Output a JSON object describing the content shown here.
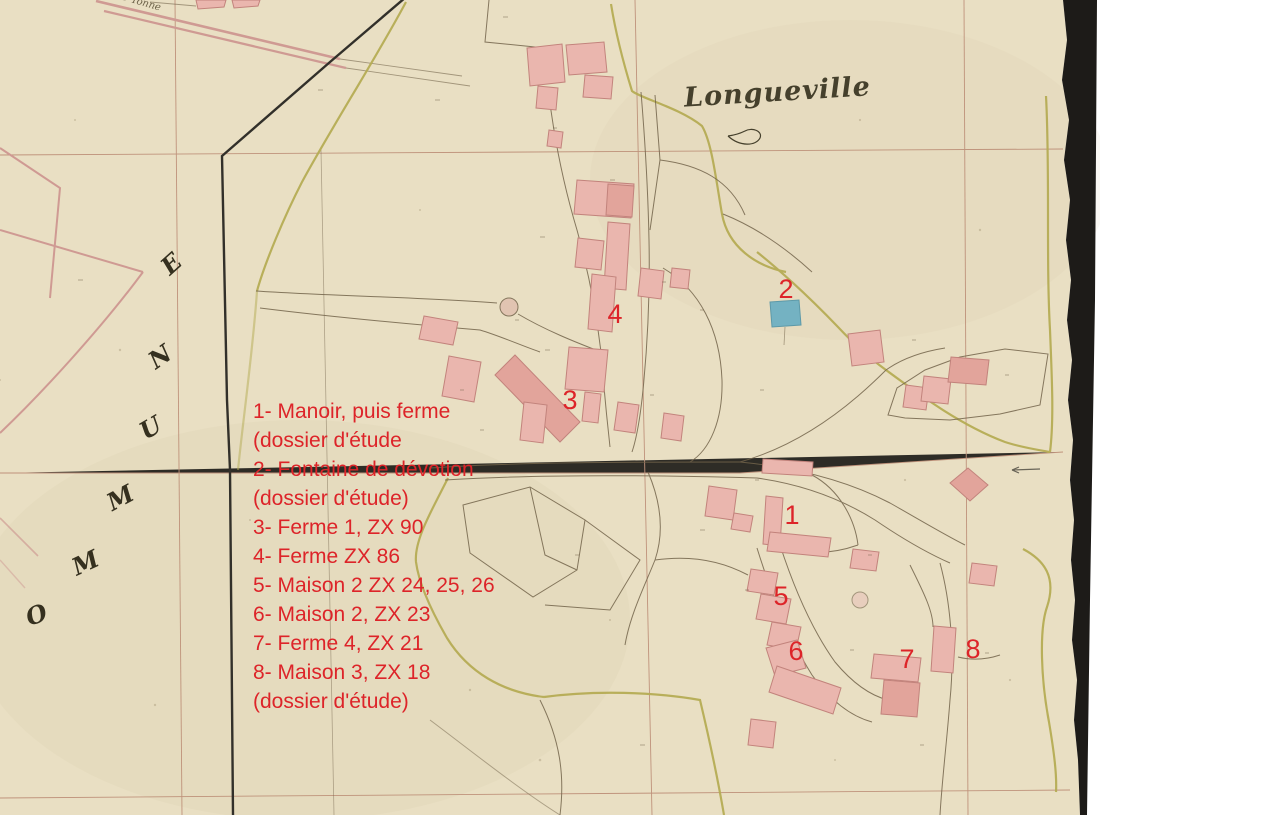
{
  "map": {
    "title": "Longueville",
    "road_label": "D'Yonne",
    "commune_letters": [
      {
        "ch": "O",
        "x": 26,
        "y": 600,
        "rot": -20
      },
      {
        "ch": "M",
        "x": 72,
        "y": 548,
        "rot": -25
      },
      {
        "ch": "M",
        "x": 107,
        "y": 483,
        "rot": -28
      },
      {
        "ch": "U",
        "x": 140,
        "y": 413,
        "rot": -30
      },
      {
        "ch": "N",
        "x": 149,
        "y": 342,
        "rot": -35
      },
      {
        "ch": "E",
        "x": 162,
        "y": 249,
        "rot": -42
      }
    ],
    "markers": [
      {
        "n": "1",
        "x": 792,
        "y": 517
      },
      {
        "n": "2",
        "x": 786,
        "y": 291
      },
      {
        "n": "3",
        "x": 570,
        "y": 402
      },
      {
        "n": "4",
        "x": 615,
        "y": 316
      },
      {
        "n": "5",
        "x": 781,
        "y": 598
      },
      {
        "n": "6",
        "x": 796,
        "y": 653
      },
      {
        "n": "7",
        "x": 907,
        "y": 661
      },
      {
        "n": "8",
        "x": 973,
        "y": 651
      }
    ],
    "legend_lines": [
      "1- Manoir, puis ferme",
      "(dossier d'étude",
      "2- Fontaine de dévotion",
      "(dossier d'étude)",
      "3- Ferme 1, ZX 90",
      "4- Ferme ZX 86",
      "5- Maison 2 ZX 24, 25, 26",
      "6- Maison 2, ZX 23",
      "7- Ferme 4, ZX 21",
      "8- Maison 3, ZX 18",
      "(dossier d'étude)"
    ]
  },
  "colors": {
    "paper": "#e9dfc3",
    "ink": "#73644b",
    "ink_dark": "#32302a",
    "grid_red": "#b5806a",
    "road_olive": "#b6ac55",
    "road_pink": "#cf9a93",
    "building_fill": "#eab6ae",
    "building_fill_dark": "#e2a49b",
    "building_stroke": "#c2837c",
    "water_blue": "#74b2c2",
    "annotation_red": "#dd2429",
    "title_ink": "#45402c",
    "scan_black": "#1d1b18"
  }
}
